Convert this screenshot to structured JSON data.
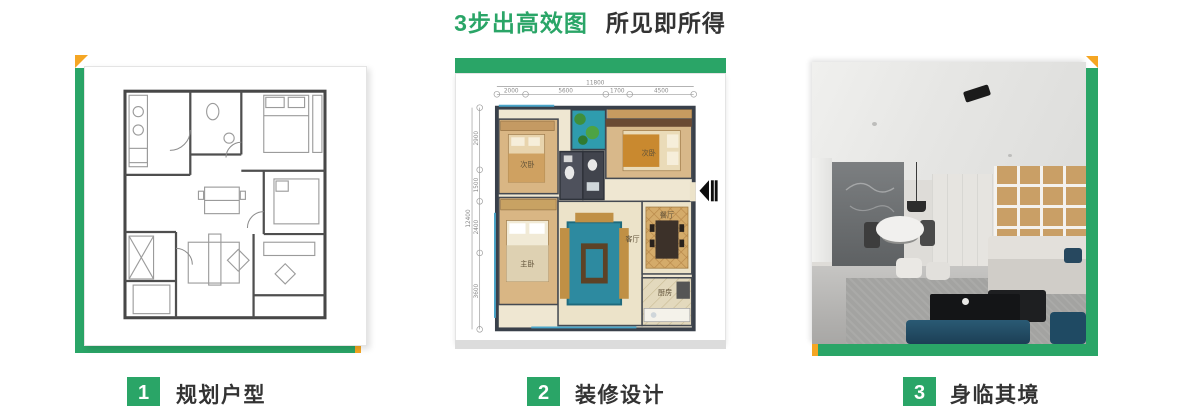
{
  "title": {
    "highlight": "3步出高效图",
    "rest": "所见即所得"
  },
  "colors": {
    "green": "#2aa567",
    "orange": "#f5a623",
    "dark_text": "#333333"
  },
  "steps": [
    {
      "number": "1",
      "label": "规划户型"
    },
    {
      "number": "2",
      "label": "装修设计"
    },
    {
      "number": "3",
      "label": "身临其境"
    }
  ],
  "panels": [
    {
      "name": "cad-floorplan-sketch"
    },
    {
      "name": "colored-floorplan"
    },
    {
      "name": "interior-render-photo"
    }
  ],
  "floorplan": {
    "dims_top": {
      "total": "11800",
      "segments": [
        "2000",
        "5600",
        "1700",
        "4500"
      ]
    },
    "dims_left": {
      "total": "12400",
      "segments": [
        "2900",
        "1500",
        "2400",
        "3600"
      ]
    },
    "rooms": {
      "bedroom_a": "次卧",
      "bedroom_b": "次卧",
      "master": "主卧",
      "living": "客厅",
      "dining": "餐厅",
      "kitchen": "厨房"
    }
  }
}
